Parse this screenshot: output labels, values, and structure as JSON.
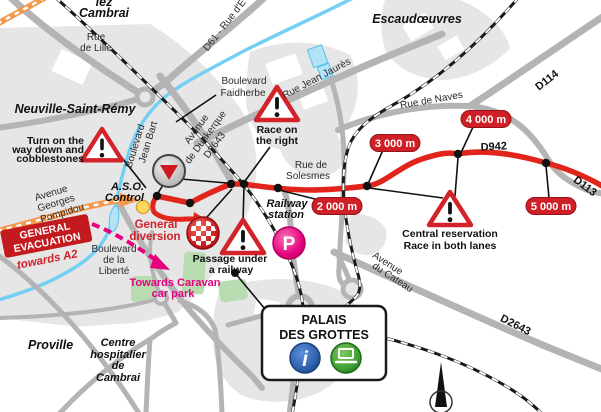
{
  "towns": {
    "lez_cambrai": [
      "lez",
      "Cambrai"
    ],
    "neuville": "Neuville-Saint-Rémy",
    "escaudoeuvres": "Escaudœuvres",
    "proville": "Proville"
  },
  "streets": {
    "rue_de_lille": [
      "Rue",
      "de Lille"
    ],
    "d61": "D61 - Rue d'E",
    "bd_faidherbe": [
      "Boulevard",
      "Faidherbe"
    ],
    "av_dunkerque": [
      "Avenue",
      "de Dunkerque",
      "D2643"
    ],
    "bd_jean_bart": [
      "Boulevard",
      "Jean Bart"
    ],
    "rue_jean_jaures": "Rue Jean Jaurès",
    "rue_de_naves": "Rue de Naves",
    "d114": "D114",
    "rue_de_solesmes": [
      "Rue de",
      "Solesmes"
    ],
    "d942": "D942",
    "d113": "D113",
    "av_pompidou": [
      "Avenue",
      "Georges",
      "Pompidou"
    ],
    "bd_liberte": [
      "Boulevard",
      "de la",
      "Liberté"
    ],
    "av_cateau": [
      "Avenue",
      "du Cateau"
    ],
    "d2643": "D2643"
  },
  "landmarks": {
    "hospital": [
      "Centre",
      "hospitalier",
      "de",
      "Cambrai"
    ],
    "railway_station": [
      "Railway",
      "station"
    ],
    "palais": [
      "PALAIS",
      "DES GROTTES"
    ],
    "parking_letter": "P"
  },
  "race": {
    "aso_control": [
      "A.S.O.",
      "Control"
    ],
    "general_diversion": [
      "General",
      "diversion"
    ],
    "distance_markers": [
      "2 000 m",
      "3 000 m",
      "4 000 m",
      "5 000 m"
    ],
    "evacuation_banner": [
      "GENERAL",
      "EVACUATION"
    ],
    "evacuation_direction": "towards A2",
    "caravan": [
      "Towards Caravan",
      "car park"
    ]
  },
  "warnings": {
    "cobblestones": [
      "Turn on the",
      "way down and",
      "cobblestones"
    ],
    "race_right": [
      "Race on",
      "the right"
    ],
    "passage": [
      "Passage under",
      "a railway"
    ],
    "central": [
      "Central reservation",
      "Race in both lanes"
    ]
  },
  "colors": {
    "route_red": "#e1251b",
    "road_gray": "#b5b4b4",
    "urban_gray": "#e7e6e6",
    "canal_blue": "#74d0f2",
    "magenta": "#e6007e",
    "orange": "#f2994d",
    "park_green": "#b8dcb0",
    "warning_red": "#d2232a"
  }
}
